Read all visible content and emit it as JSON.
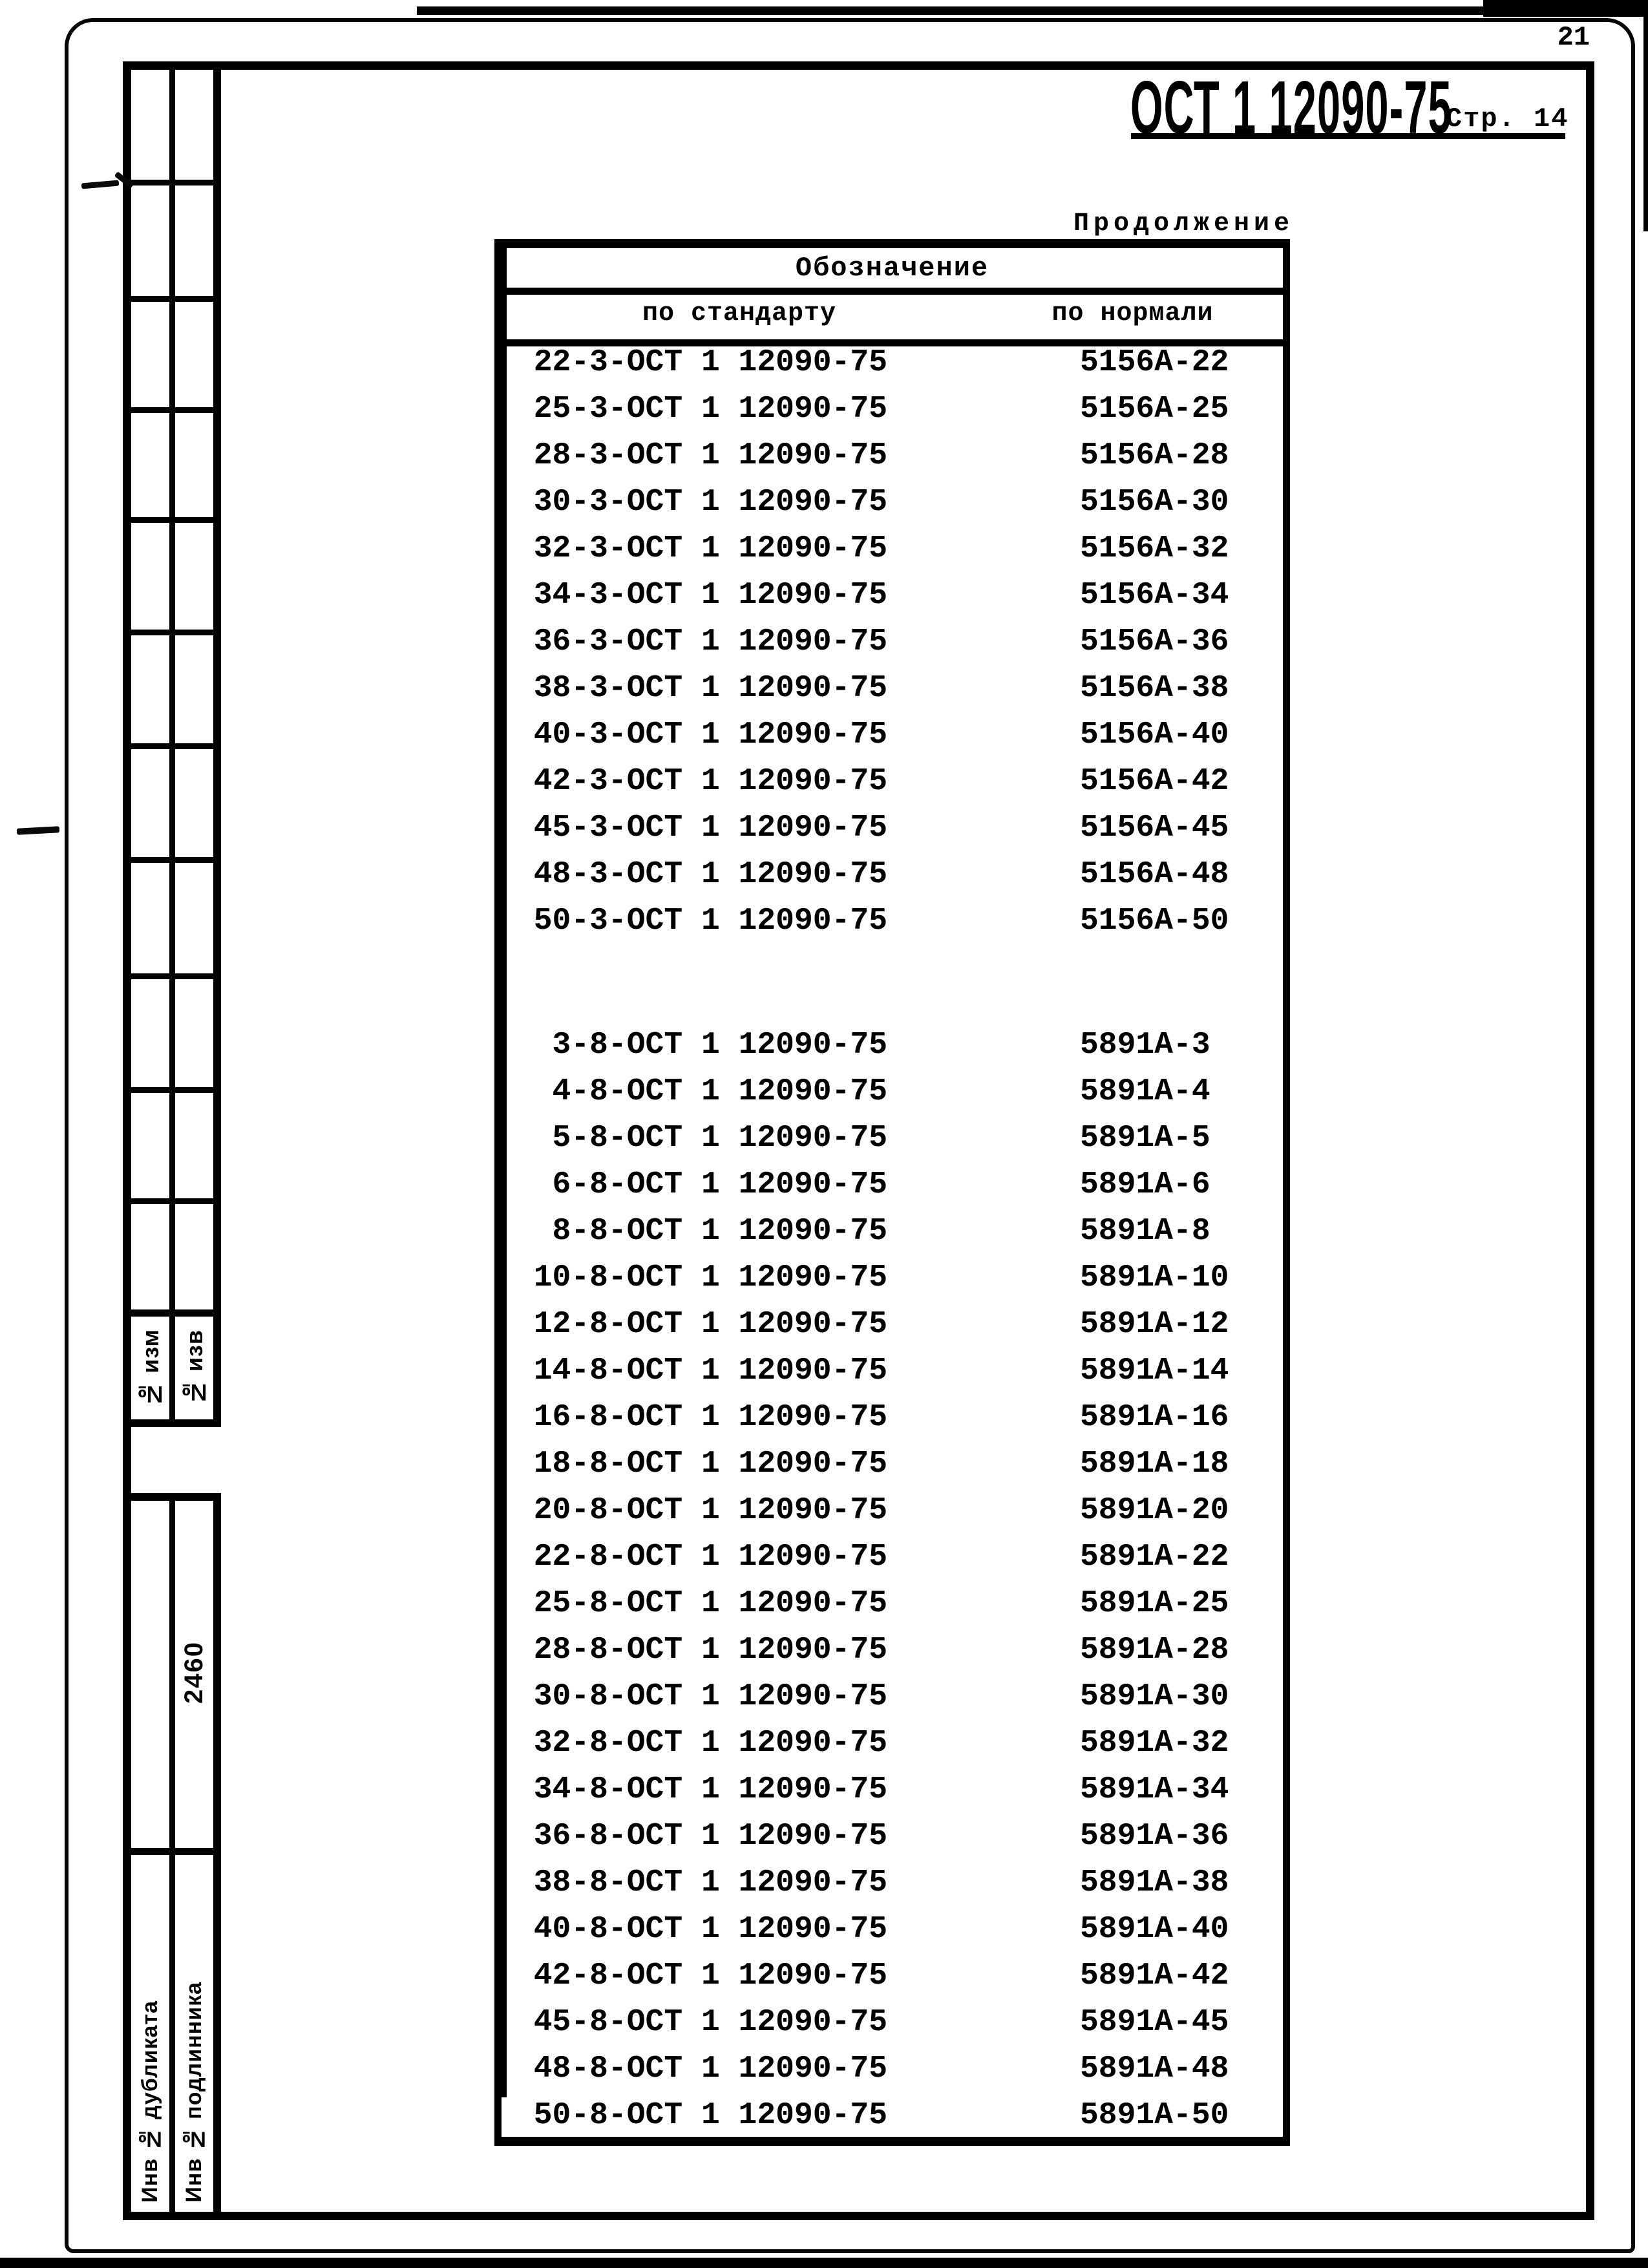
{
  "colors": {
    "ink": "#000000",
    "paper": "#ffffff"
  },
  "page": {
    "corner_number": "21"
  },
  "header": {
    "standard_code": "ОСТ 1 12090-75",
    "page_label": "Стр. 14"
  },
  "table": {
    "continuation_label": "Продолжение",
    "group_header": "Обозначение",
    "col_standard": "по стандарту",
    "col_normal": "по нормали",
    "rows_group1": [
      {
        "s": "22-3-ОСТ 1 12090-75",
        "n": "5156А-22"
      },
      {
        "s": "25-3-ОСТ 1 12090-75",
        "n": "5156А-25"
      },
      {
        "s": "28-3-ОСТ 1 12090-75",
        "n": "5156А-28"
      },
      {
        "s": "30-3-ОСТ 1 12090-75",
        "n": "5156А-30"
      },
      {
        "s": "32-3-ОСТ 1 12090-75",
        "n": "5156А-32"
      },
      {
        "s": "34-3-ОСТ 1 12090-75",
        "n": "5156А-34"
      },
      {
        "s": "36-3-ОСТ 1 12090-75",
        "n": "5156А-36"
      },
      {
        "s": "38-3-ОСТ 1 12090-75",
        "n": "5156А-38"
      },
      {
        "s": "40-3-ОСТ 1 12090-75",
        "n": "5156А-40"
      },
      {
        "s": "42-3-ОСТ 1 12090-75",
        "n": "5156А-42"
      },
      {
        "s": "45-3-ОСТ 1 12090-75",
        "n": "5156А-45"
      },
      {
        "s": "48-3-ОСТ 1 12090-75",
        "n": "5156А-48"
      },
      {
        "s": "50-3-ОСТ 1 12090-75",
        "n": "5156А-50"
      }
    ],
    "rows_group2": [
      {
        "s": "3-8-ОСТ 1 12090-75",
        "n": "5891А-3"
      },
      {
        "s": "4-8-ОСТ 1 12090-75",
        "n": "5891А-4"
      },
      {
        "s": "5-8-ОСТ 1 12090-75",
        "n": "5891А-5"
      },
      {
        "s": "6-8-ОСТ 1 12090-75",
        "n": "5891А-6"
      },
      {
        "s": "8-8-ОСТ 1 12090-75",
        "n": "5891А-8"
      },
      {
        "s": "10-8-ОСТ 1 12090-75",
        "n": "5891А-10"
      },
      {
        "s": "12-8-ОСТ 1 12090-75",
        "n": "5891А-12"
      },
      {
        "s": "14-8-ОСТ 1 12090-75",
        "n": "5891А-14"
      },
      {
        "s": "16-8-ОСТ 1 12090-75",
        "n": "5891А-16"
      },
      {
        "s": "18-8-ОСТ 1 12090-75",
        "n": "5891А-18"
      },
      {
        "s": "20-8-ОСТ 1 12090-75",
        "n": "5891А-20"
      },
      {
        "s": "22-8-ОСТ 1 12090-75",
        "n": "5891А-22"
      },
      {
        "s": "25-8-ОСТ 1 12090-75",
        "n": "5891А-25"
      },
      {
        "s": "28-8-ОСТ 1 12090-75",
        "n": "5891А-28"
      },
      {
        "s": "30-8-ОСТ 1 12090-75",
        "n": "5891А-30"
      },
      {
        "s": "32-8-ОСТ 1 12090-75",
        "n": "5891А-32"
      },
      {
        "s": "34-8-ОСТ 1 12090-75",
        "n": "5891А-34"
      },
      {
        "s": "36-8-ОСТ 1 12090-75",
        "n": "5891А-36"
      },
      {
        "s": "38-8-ОСТ 1 12090-75",
        "n": "5891А-38"
      },
      {
        "s": "40-8-ОСТ 1 12090-75",
        "n": "5891А-40"
      },
      {
        "s": "42-8-ОСТ 1 12090-75",
        "n": "5891А-42"
      },
      {
        "s": "45-8-ОСТ 1 12090-75",
        "n": "5891А-45"
      },
      {
        "s": "48-8-ОСТ 1 12090-75",
        "n": "5891А-48"
      },
      {
        "s": "50-8-ОСТ 1 12090-75",
        "n": "5891А-50"
      }
    ]
  },
  "sidebar": {
    "col_izm_label": "№ изм",
    "col_izv_label": "№ изв",
    "form_code": "2460",
    "inv_duplicate": "Инв № дубликата",
    "inv_original": "Инв № подлинника"
  }
}
